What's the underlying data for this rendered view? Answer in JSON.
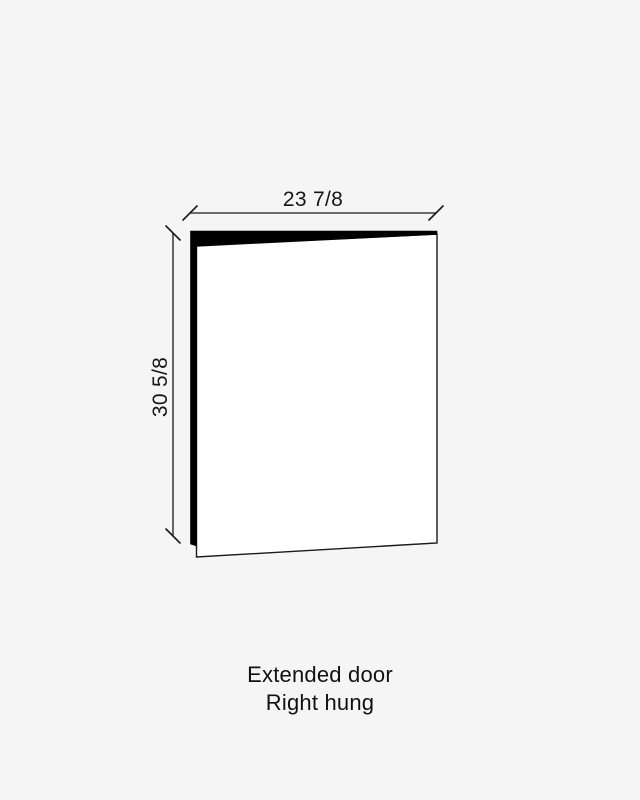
{
  "page": {
    "background_color": "#f5f5f5"
  },
  "diagram": {
    "type": "cabinet-door-technical-drawing",
    "line_color": "#1a1a1a",
    "door_face_fill": "#ffffff",
    "door_edge_fill": "#000000",
    "dimensions": {
      "width_label": "23 7/8",
      "height_label": "30 5/8"
    }
  },
  "caption": {
    "line1": "Extended door",
    "line2": "Right hung"
  }
}
